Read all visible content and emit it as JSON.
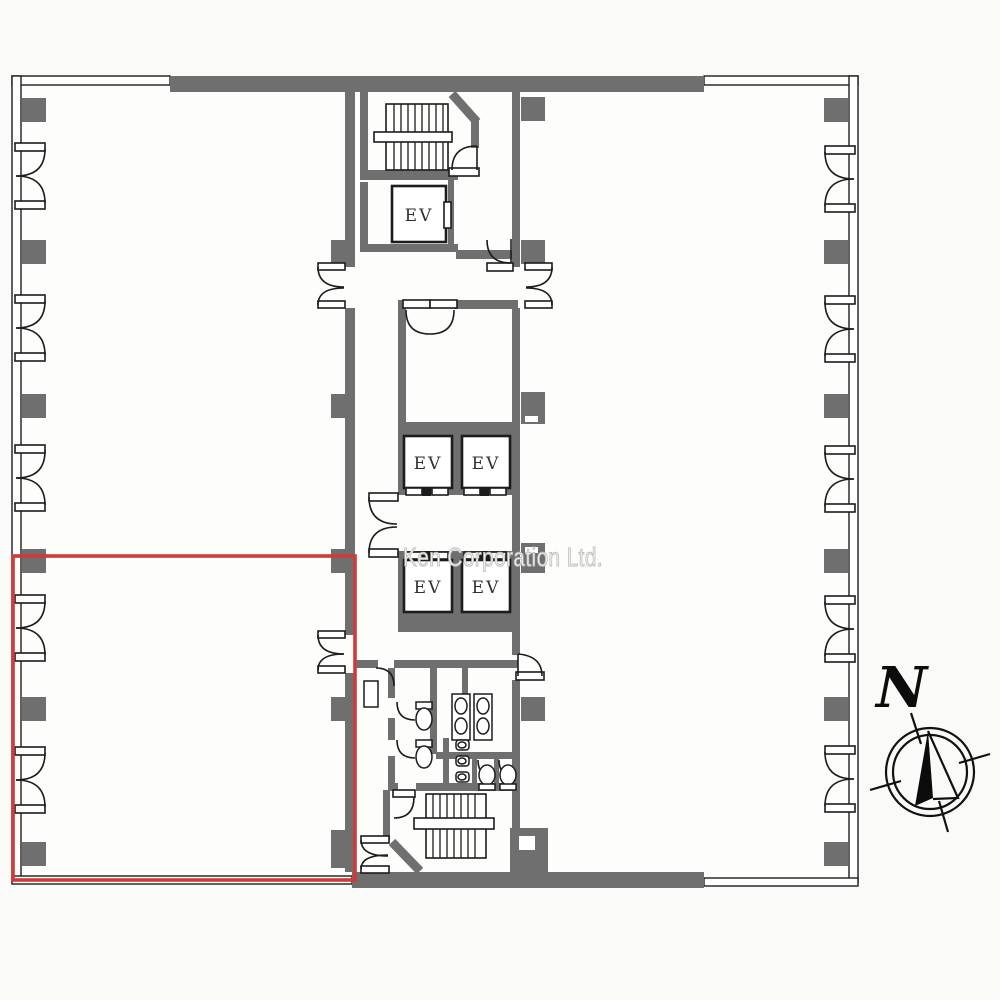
{
  "plan": {
    "watermark": "Ken Corporation Ltd.",
    "compass": {
      "north_label": "N"
    },
    "elevators": [
      {
        "label": "EV"
      },
      {
        "label": "EV"
      },
      {
        "label": "EV"
      },
      {
        "label": "EV"
      },
      {
        "label": "EV"
      }
    ],
    "colors": {
      "wall": "#6f6f6f",
      "line": "#1c1c1c",
      "watermark": "#bdbdbb",
      "highlight": "#cf3a3a",
      "background": "#fafaf8"
    }
  }
}
